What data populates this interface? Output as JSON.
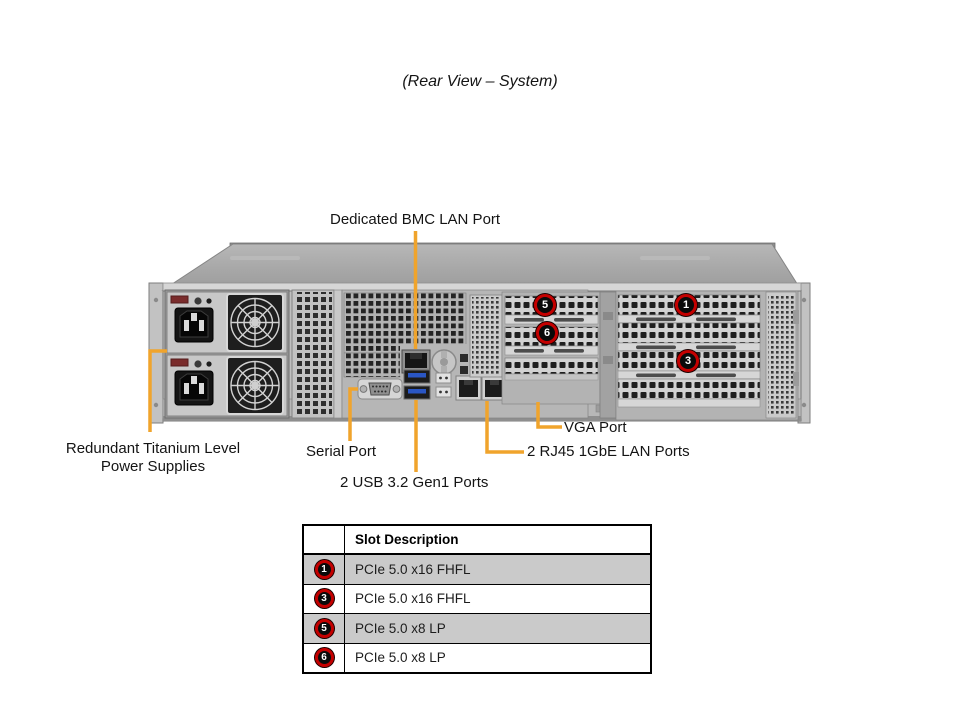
{
  "title": "(Rear View – System)",
  "callouts": {
    "bmc_lan": "Dedicated BMC LAN Port",
    "power_supplies": "Redundant Titanium Level Power Supplies",
    "serial": "Serial Port",
    "usb": "2 USB 3.2 Gen1 Ports",
    "lan": "2 RJ45 1GbE LAN Ports",
    "vga": "VGA Port"
  },
  "slot_markers": {
    "s1": "1",
    "s3": "3",
    "s5": "5",
    "s6": "6"
  },
  "table": {
    "header": "Slot Description",
    "rows": [
      {
        "slot": "1",
        "description": "PCIe 5.0 x16 FHFL",
        "shaded": true
      },
      {
        "slot": "3",
        "description": "PCIe 5.0 x16 FHFL",
        "shaded": false
      },
      {
        "slot": "5",
        "description": "PCIe 5.0 x8 LP",
        "shaded": true
      },
      {
        "slot": "6",
        "description": "PCIe 5.0 x8 LP",
        "shaded": false
      }
    ]
  },
  "colors": {
    "callout_line": "#F0A42C",
    "badge_ring": "#C40000",
    "badge_fill": "#0A0A0A",
    "table_shaded_row": "#CACACA"
  }
}
